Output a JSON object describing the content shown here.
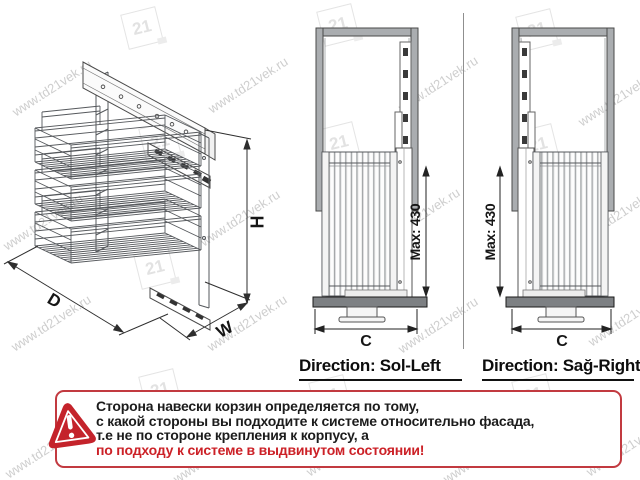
{
  "watermark": {
    "text": "www.td21vek.ru",
    "logo_text": "21"
  },
  "isometric": {
    "dim_depth": "D",
    "dim_width": "W",
    "dim_height": "H"
  },
  "views": {
    "left": {
      "max_label": "Max: 430",
      "width_label": "C",
      "direction": "Direction: Sol-Left"
    },
    "right": {
      "max_label": "Max: 430",
      "width_label": "C",
      "direction": "Direction: Sağ-Right"
    }
  },
  "warning": {
    "lines": [
      "Сторона навески корзин определяется по тому,",
      "с какой стороны вы подходите к системе относительно фасада,",
      "т.е не по стороне крепления к корпусу, а",
      "по подходу к системе в выдвинутом состоянии!"
    ],
    "accent_red": "#c4232b"
  }
}
